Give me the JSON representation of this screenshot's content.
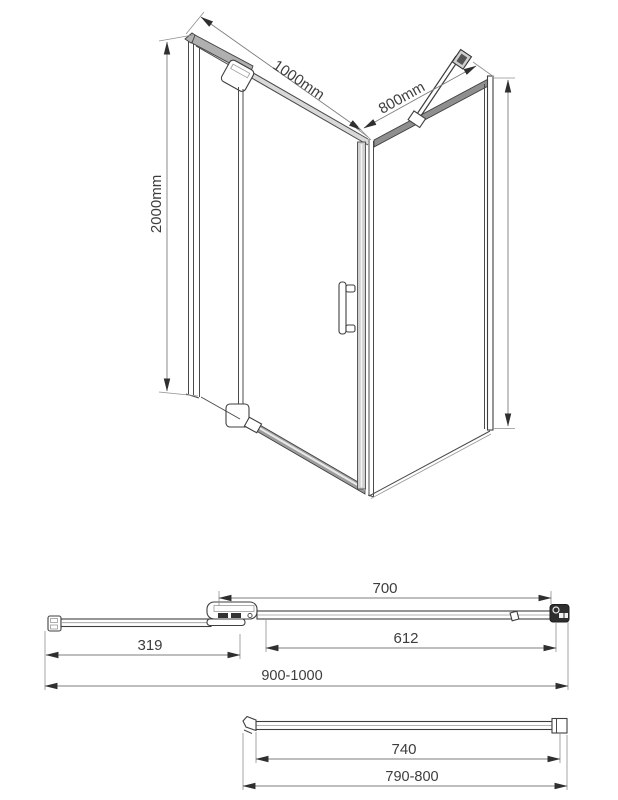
{
  "drawing": {
    "title": "Shower enclosure dimensional drawing",
    "background": "#ffffff",
    "line_color": "#4a4a4a",
    "text_color": "#3d3d3d",
    "perspective_view": {
      "name": "Corner shower enclosure perspective view",
      "labels": {
        "front_width": "1000mm",
        "side_width": "800mm",
        "height": "2000mm"
      }
    },
    "door_wall_plan": {
      "name": "Door wall top view",
      "labels": {
        "door_unit_width": "700",
        "door_glass_width": "612",
        "fixed_panel_width": "319",
        "overall_adjustment_range": "900-1000"
      }
    },
    "side_panel_plan": {
      "name": "Side panel top view",
      "labels": {
        "glass_width": "740",
        "overall_adjustment_range": "790-800"
      }
    }
  }
}
